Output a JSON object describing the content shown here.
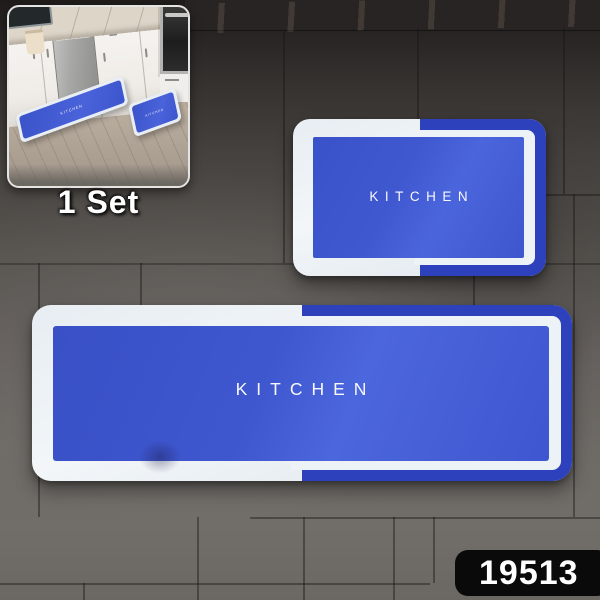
{
  "product": {
    "set_label": "1 Set",
    "sku": "19513",
    "large_mat_text": "KITCHEN",
    "small_mat_text": "KITCHEN",
    "inset_runner_text": "KITCHEN",
    "inset_small_mat_text": "KITCHEN"
  },
  "colors": {
    "mat_blue": "#3e57d0",
    "mat_blue_deep": "#2c41bb",
    "mat_border_white": "#edf2f6",
    "tile_dark_top": "#262322",
    "tile_mid": "#57534f",
    "tile_light_bottom": "#6e6a66",
    "badge_bg": "#0a0a0a",
    "badge_text": "#ffffff",
    "floor_wood": "#bcb0a1",
    "cabinet_white": "#f3f1ee",
    "steel_gray": "#a7a7a5",
    "oven_black": "#1d1d1d",
    "marble_counter": "#dcd5c8"
  }
}
